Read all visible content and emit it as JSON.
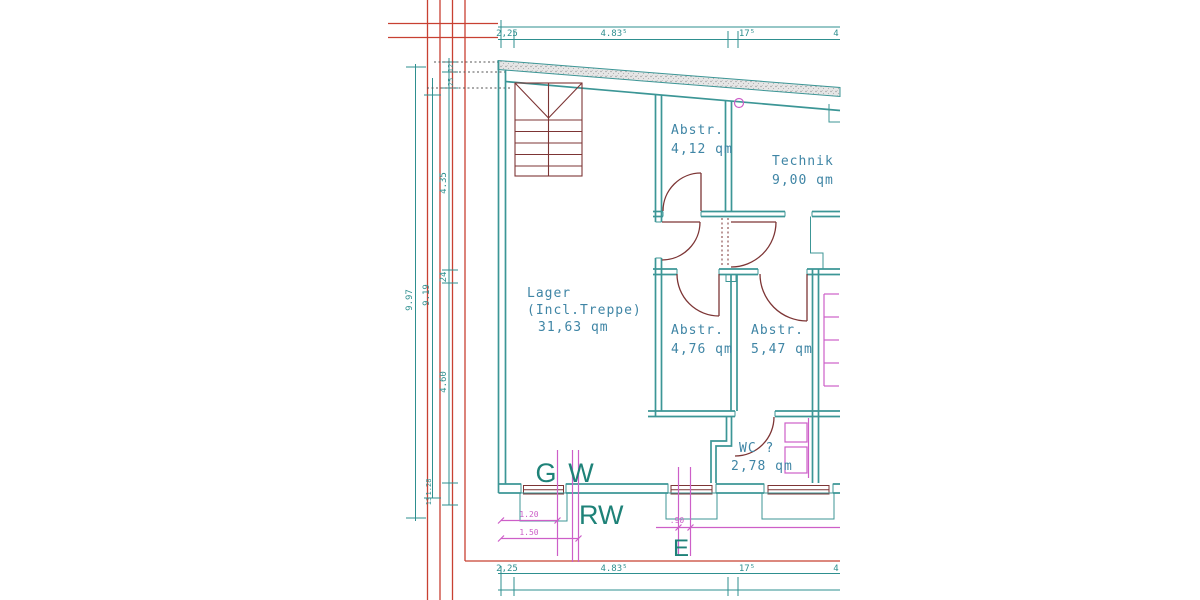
{
  "drawing": {
    "rooms": {
      "lager": {
        "name": "Lager",
        "detail": "(Incl.Treppe)",
        "area": "31,63 qm"
      },
      "abstr1": {
        "name": "Abstr.",
        "area": "4,12 qm"
      },
      "technik": {
        "name": "Technik",
        "area": "9,00 qm"
      },
      "abstr2": {
        "name": "Abstr.",
        "area": "4,76 qm"
      },
      "abstr3": {
        "name": "Abstr.",
        "area": "5,47 qm"
      },
      "wc": {
        "name": "WC ?",
        "area": "2,78 qm"
      }
    },
    "utilities": {
      "g": "G",
      "w": "W",
      "rw": "RW",
      "e": "E"
    },
    "dims": {
      "horizontal": [
        "2,25",
        "4.83⁵",
        "17⁵",
        "4"
      ],
      "left_overall": "9.97",
      "left_inner": "9.19",
      "left_segments": [
        "4.35",
        "24",
        "4.60"
      ],
      "left_small": [
        "12",
        "25"
      ],
      "left_lower": [
        "1.28",
        "13"
      ],
      "magenta": [
        "1.20",
        "1.50",
        ".90"
      ]
    },
    "colors": {
      "wall": "#3c9696",
      "label_text": "#3f85a5",
      "utility_text": "#1e8278",
      "door": "#7d3535",
      "grid": "#c84032",
      "magenta": "#cd5fc8",
      "dim": "#2e8f8f"
    }
  }
}
